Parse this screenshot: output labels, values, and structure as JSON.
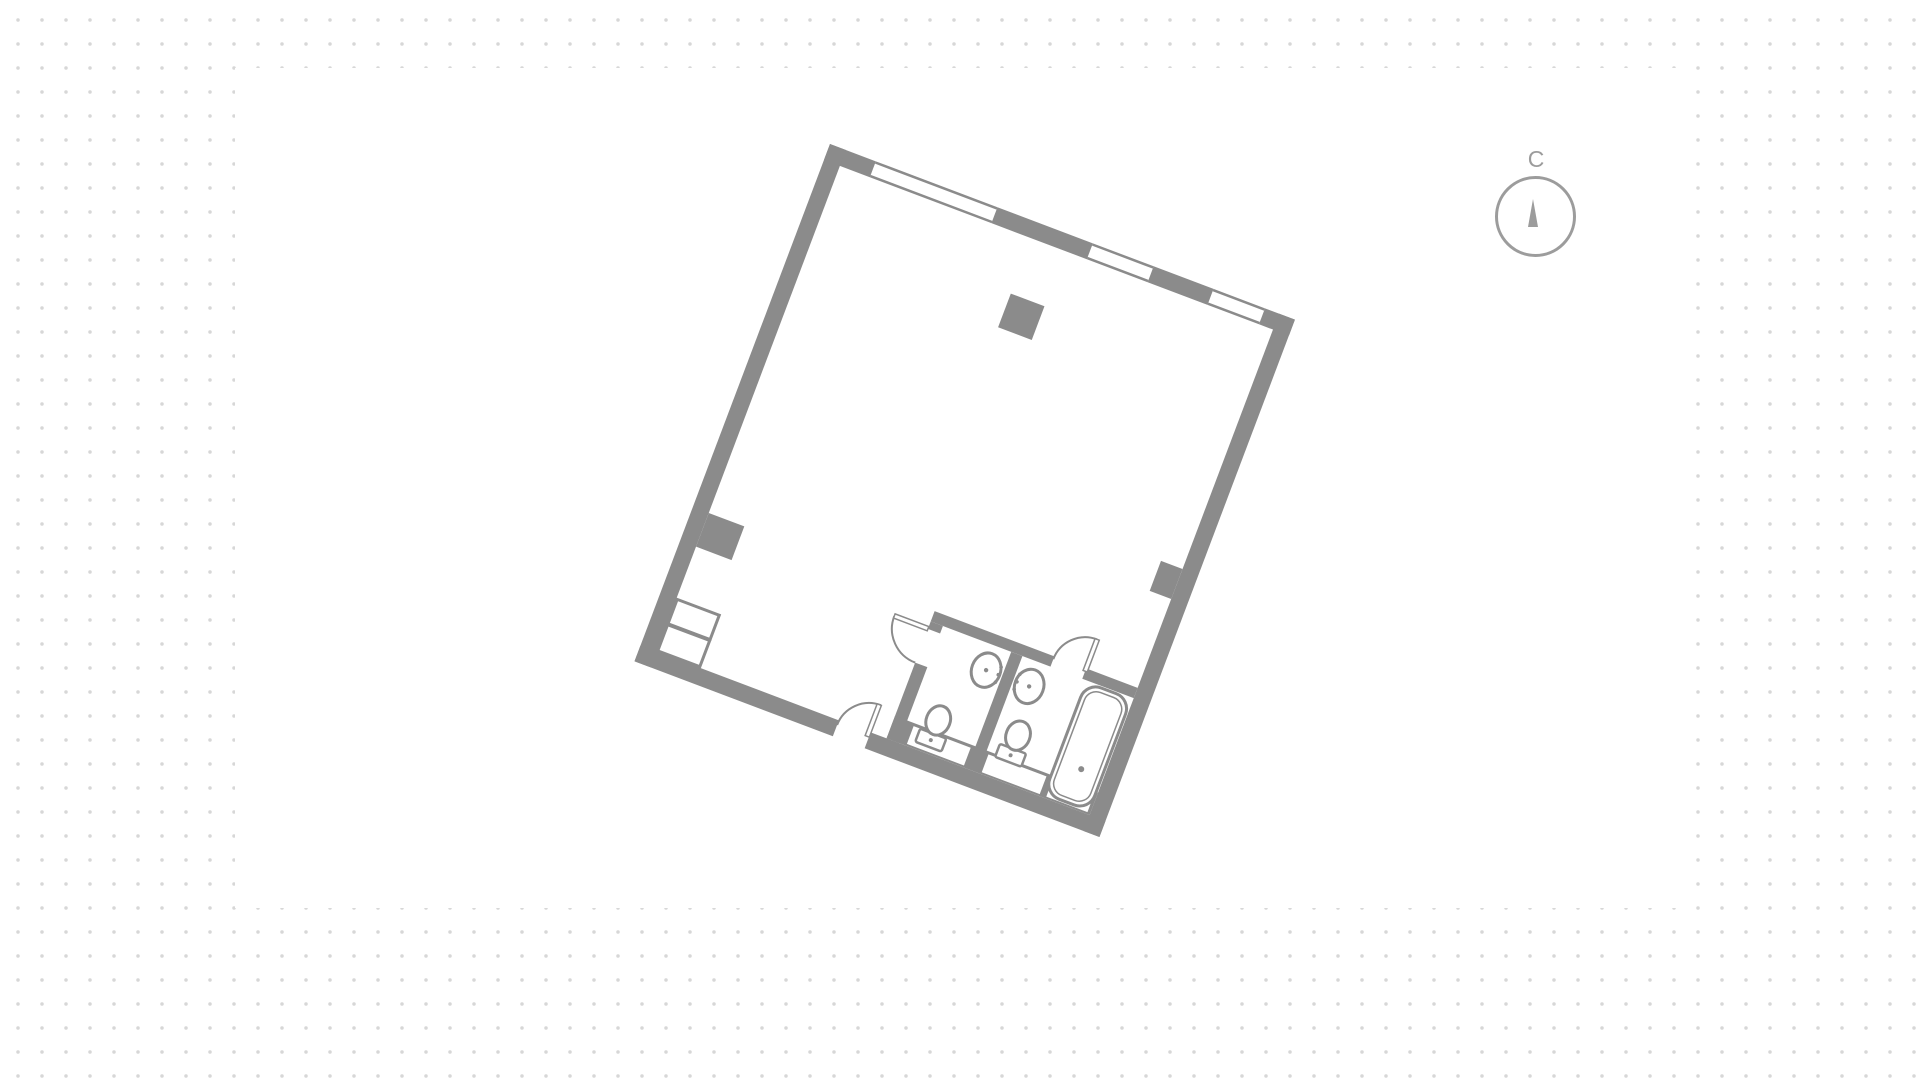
{
  "canvas": {
    "width": 1920,
    "height": 1078,
    "background": "#ffffff"
  },
  "dot_grid": {
    "color": "#d7d7d7",
    "spacing_px": 24,
    "dot_diameter_px": 3.5,
    "offset_x": 6,
    "offset_y": 8
  },
  "card": {
    "background": "#ffffff",
    "x": 235,
    "y": 68,
    "width": 1450,
    "height": 840
  },
  "compass": {
    "label": "С",
    "meaning": "north-indicator",
    "color": "#9c9c9c",
    "center_x": 1536,
    "center_y": 217,
    "radius": 40,
    "needle_direction": "up"
  },
  "floor_plan": {
    "wall_color": "#8b8b8b",
    "rotation_deg": 20.7,
    "origin_x": 830,
    "origin_y": 144,
    "outer_width": 497,
    "outer_height": 553,
    "exterior_wall_thickness": 17,
    "top_wall_windows": 3,
    "rooms": [
      {
        "name": "main-room",
        "features": [
          "structural-column",
          "left-pilaster",
          "right-pilaster",
          "corner-shaft"
        ]
      },
      {
        "name": "wc",
        "fixtures": [
          "toilet",
          "sink"
        ]
      },
      {
        "name": "bathroom",
        "fixtures": [
          "toilet",
          "sink",
          "bathtub"
        ]
      }
    ],
    "doors": [
      "entrance-door",
      "wc-door",
      "bathroom-door"
    ]
  }
}
